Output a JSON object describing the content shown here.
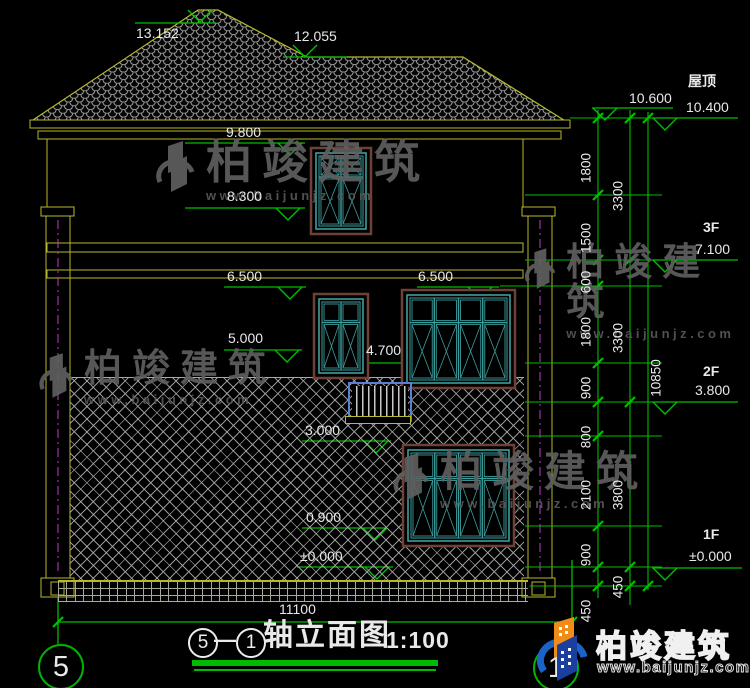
{
  "drawing": {
    "title": {
      "prefix_axis": "5",
      "suffix_axis": "1",
      "separator": "—",
      "name": "轴立面图",
      "scale": "1:100"
    },
    "axis_bubbles": {
      "left": "5",
      "right": "1"
    },
    "bottom_dim": "11100",
    "building_levels": [
      "13.152",
      "12.055",
      "9.800",
      "8.300",
      "6.500",
      "6.500",
      "5.000",
      "4.700",
      "3.000",
      "0.900",
      "±0.000"
    ],
    "right_levels": [
      {
        "floor": "",
        "value": "10.600"
      },
      {
        "floor": "屋顶",
        "value": "10.400"
      },
      {
        "floor": "3F",
        "value": "7.100"
      },
      {
        "floor": "2F",
        "value": "3.800"
      },
      {
        "floor": "1F",
        "value": "±0.000"
      }
    ],
    "dim_chain_inner": [
      "1800",
      "1500",
      "600",
      "1800",
      "900",
      "800",
      "2100",
      "900",
      "450"
    ],
    "dim_chain_middle": [
      "3300",
      "3300",
      "3800",
      "450"
    ],
    "dim_total": "10850"
  },
  "watermark": {
    "brand": "柏竣建筑",
    "url": "www.baijunjz.com"
  },
  "footer_logo": {
    "brand": "柏竣建筑",
    "url": "www.baijunjz.com"
  },
  "colors": {
    "green": "#00c000",
    "yellow": "#b9b92e",
    "teal": "#3d9d9d",
    "trim": "#6e4136",
    "magenta": "#c23ac2",
    "logo_blue": "#1c63c9",
    "logo_orange": "#ef8c1a"
  }
}
